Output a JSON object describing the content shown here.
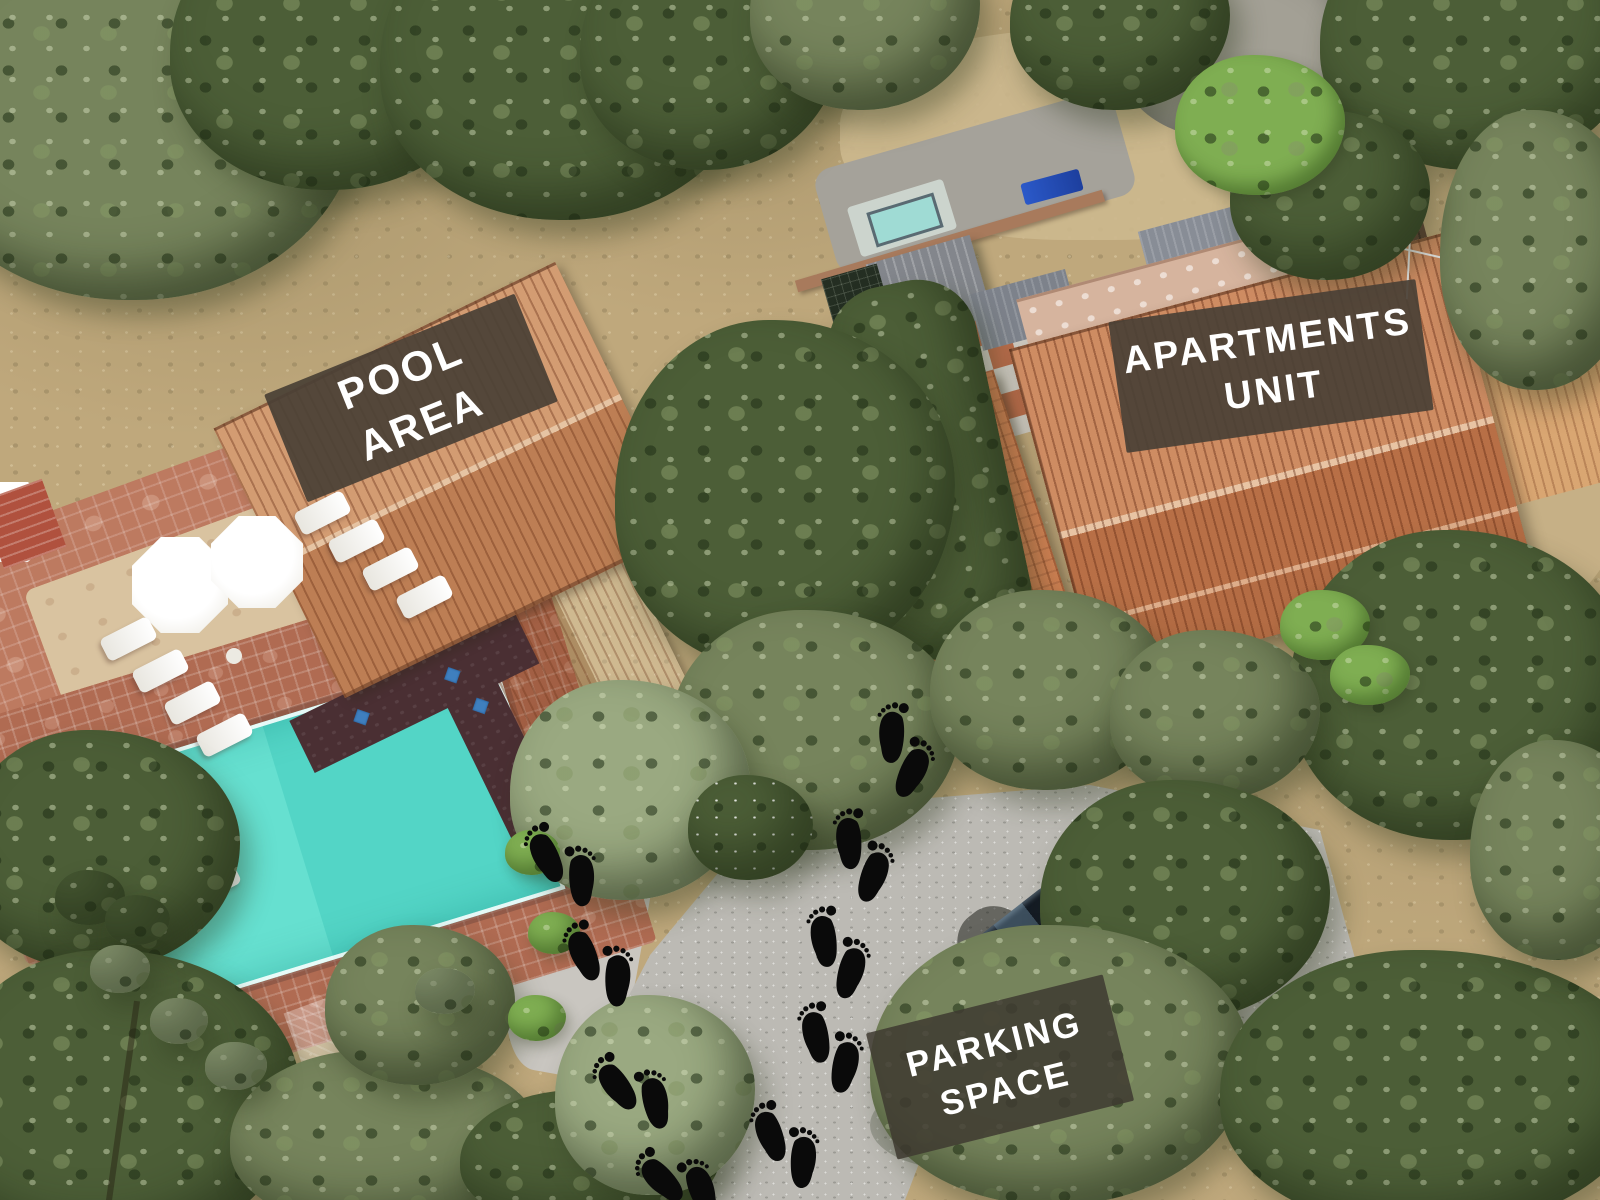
{
  "scene": {
    "type": "aerial-drone-photo",
    "description": "Top-down drone view of a holiday property: pool area building with swimming pool, apartments unit building, gravel parking space, olive trees, and a barefoot-prints trail connecting parking to the buildings"
  },
  "labels": {
    "pool_area": {
      "line1": "POOL",
      "line2": "AREA"
    },
    "apartments_unit": {
      "line1": "APARTMENTS",
      "line2": "UNIT"
    },
    "parking_space": {
      "line1": "PARKING",
      "line2": "SPACE"
    }
  },
  "annotation_style": {
    "panel_color": "#4a4136",
    "panel_opacity": 0.92,
    "text_color": "#ffffff"
  },
  "footprints": {
    "icon": "barefoot-prints",
    "color": "#0a0a0a",
    "pairs": [
      {
        "x": 903,
        "y": 752,
        "rot": 14
      },
      {
        "x": 862,
        "y": 857,
        "rot": 8
      },
      {
        "x": 838,
        "y": 954,
        "rot": 4
      },
      {
        "x": 831,
        "y": 1049,
        "rot": 0
      },
      {
        "x": 787,
        "y": 1146,
        "rot": -8
      },
      {
        "x": 564,
        "y": 866,
        "rot": -14
      },
      {
        "x": 601,
        "y": 965,
        "rot": -10
      },
      {
        "x": 636,
        "y": 1092,
        "rot": -24
      },
      {
        "x": 681,
        "y": 1183,
        "rot": -32
      }
    ]
  },
  "features": {
    "pool_color": "#59d9c9",
    "roof_color": "#c67d50",
    "gravel_color": "#bcbab4",
    "car": "dark hatchback parked by trees"
  }
}
